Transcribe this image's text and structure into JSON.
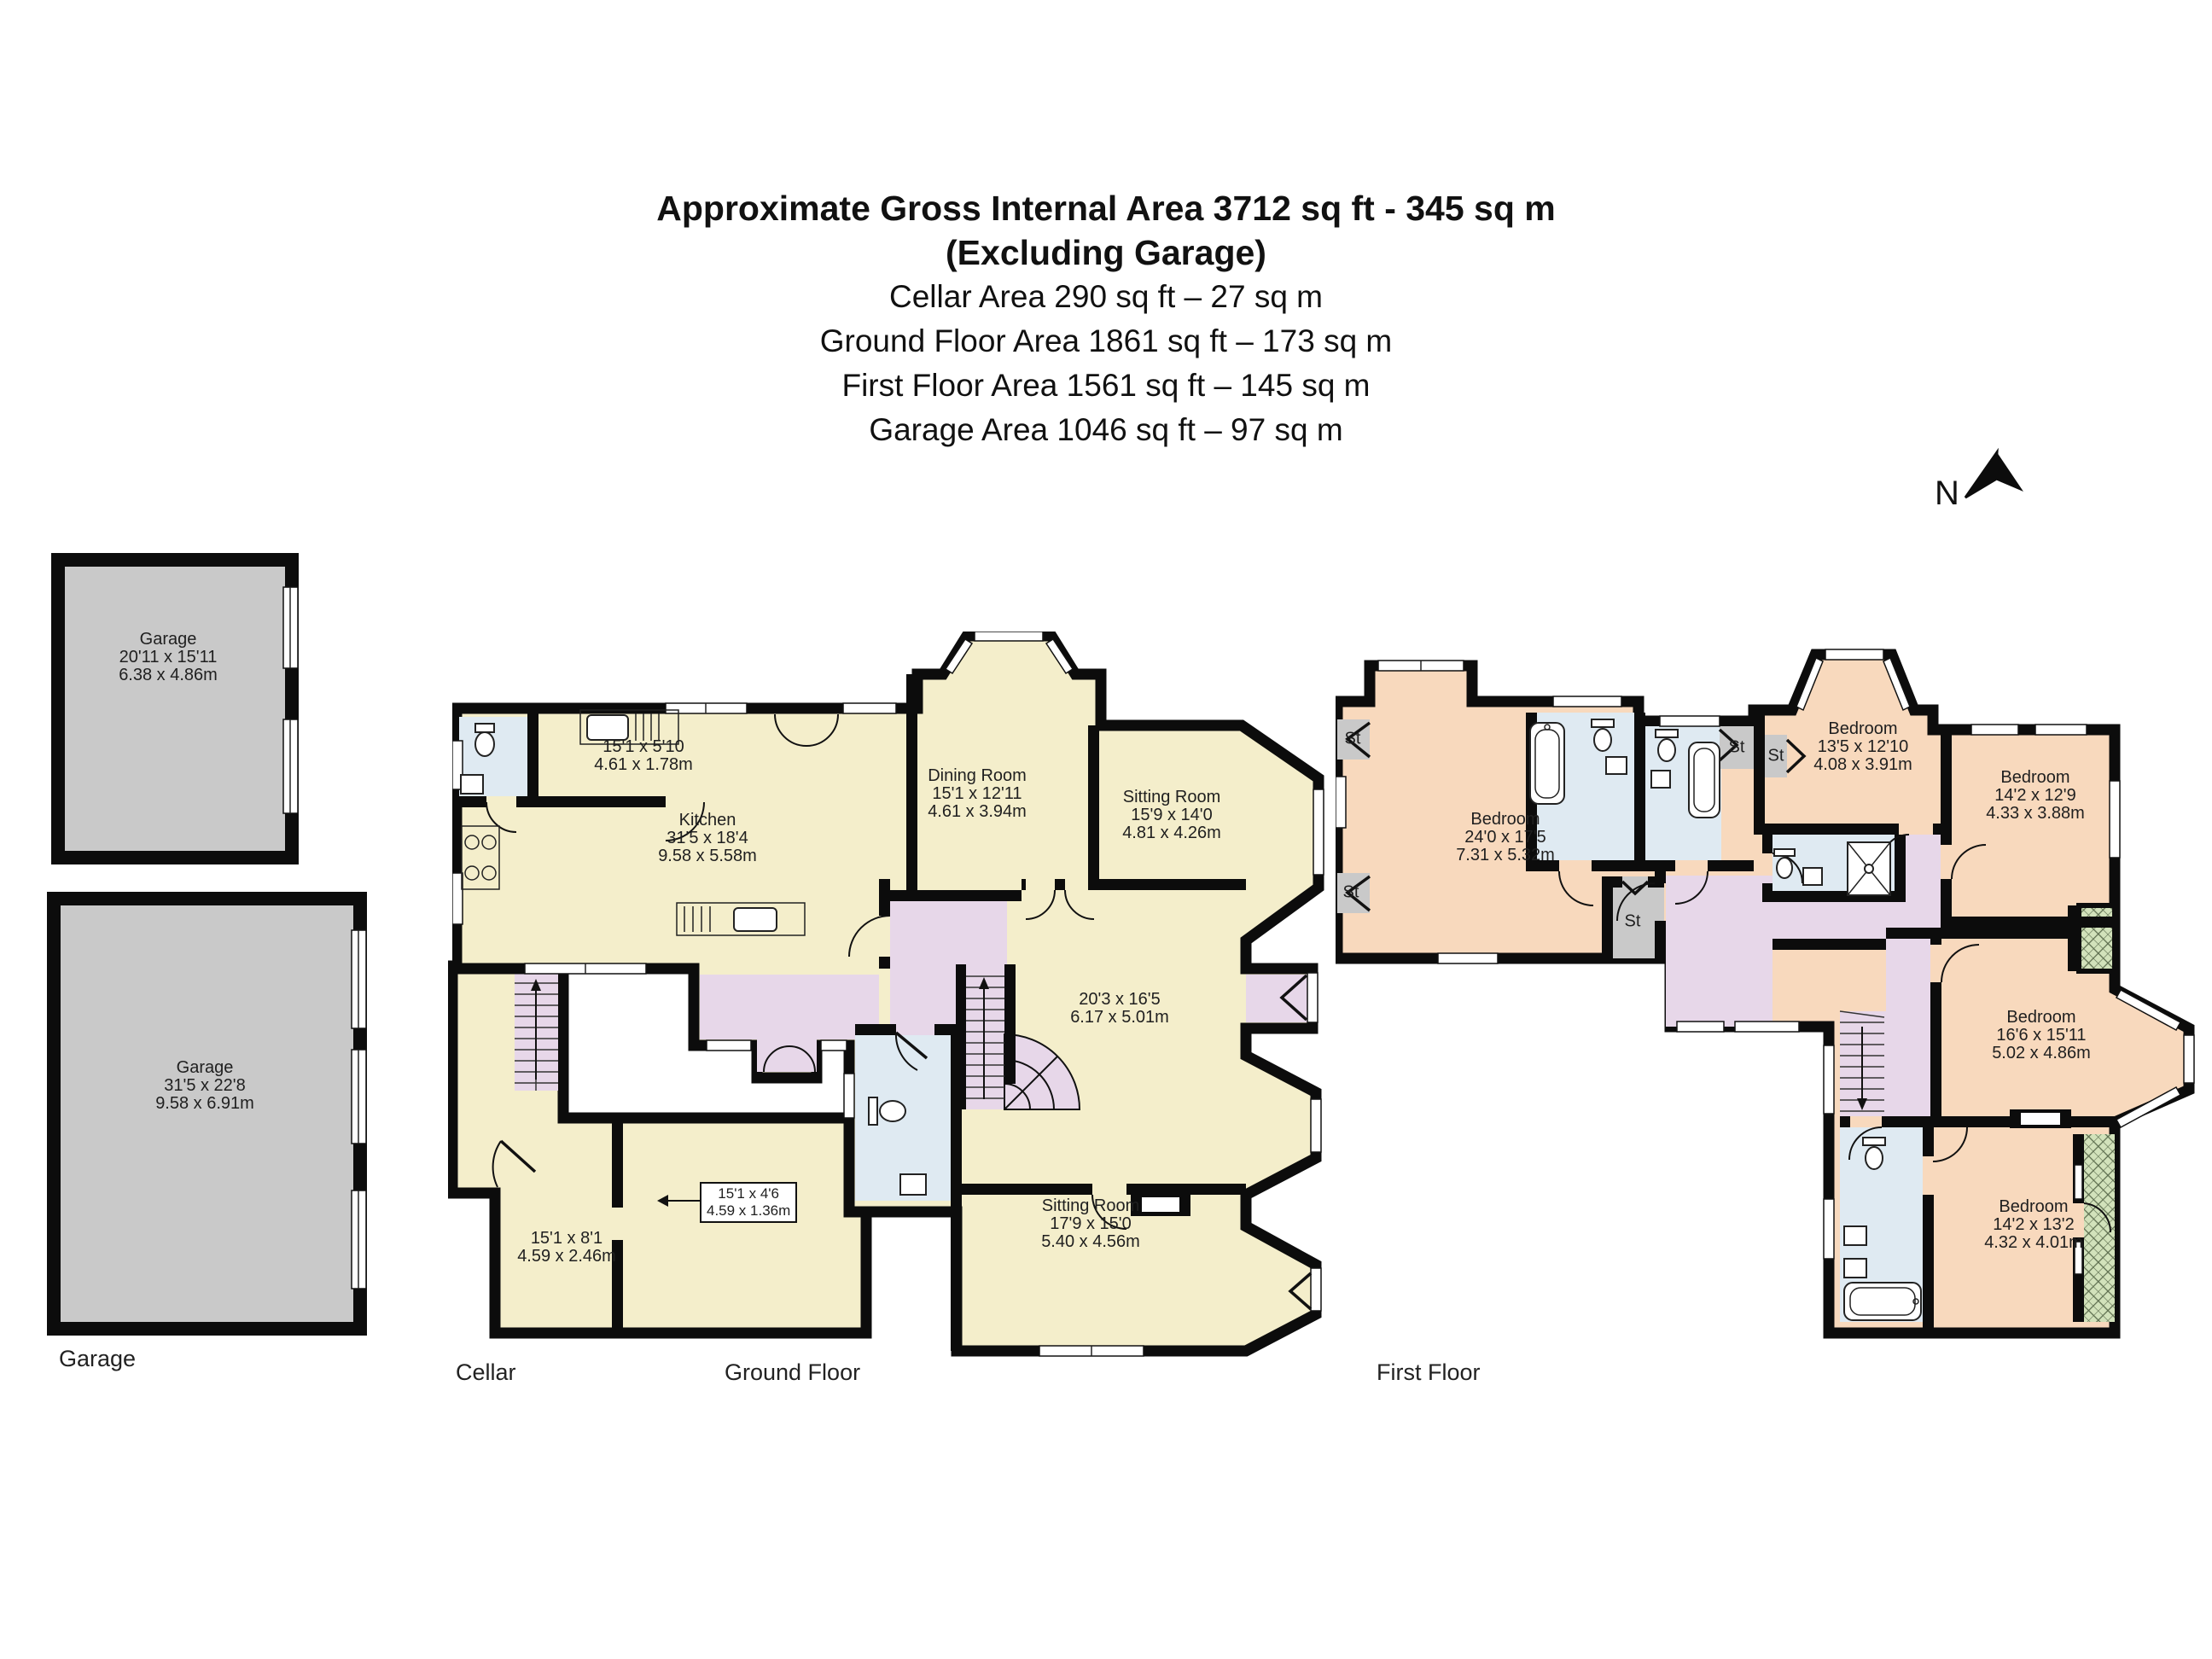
{
  "header": {
    "title": "Approximate Gross Internal Area 3712 sq ft - 345 sq m",
    "subtitle": "(Excluding Garage)",
    "areas": [
      "Cellar Area 290 sq ft – 27 sq m",
      "Ground Floor Area 1861 sq ft – 173 sq m",
      "First Floor Area 1561 sq ft – 145 sq m",
      "Garage Area 1046 sq ft – 97 sq m"
    ]
  },
  "compass": {
    "north": "N"
  },
  "captions": {
    "garage": "Garage",
    "cellar": "Cellar",
    "ground": "Ground Floor",
    "first": "First Floor"
  },
  "plans": {
    "garage_top": {
      "name": "Garage",
      "imperial": "20'11 x 15'11",
      "metric": "6.38 x 4.86m"
    },
    "garage_main": {
      "name": "Garage",
      "imperial": "31'5 x 22'8",
      "metric": "9.58 x 6.91m"
    },
    "cellar": {
      "room": {
        "imperial": "15'1 x 8'1",
        "metric": "4.59 x 2.46m"
      },
      "callout": {
        "imperial": "15'1 x 4'6",
        "metric": "4.59 x 1.36m"
      }
    },
    "ground": {
      "utility": {
        "imperial": "15'1 x 5'10",
        "metric": "4.61 x 1.78m"
      },
      "kitchen": {
        "name": "Kitchen",
        "imperial": "31'5 x 18'4",
        "metric": "9.58 x 5.58m"
      },
      "dining": {
        "name": "Dining Room",
        "imperial": "15'1 x 12'11",
        "metric": "4.61 x 3.94m"
      },
      "sitting_top": {
        "name": "Sitting Room",
        "imperial": "15'9 x 14'0",
        "metric": "4.81 x 4.26m"
      },
      "hall": {
        "imperial": "20'3 x 16'5",
        "metric": "6.17 x 5.01m"
      },
      "sitting_bottom": {
        "name": "Sitting Room",
        "imperial": "17'9 x 15'0",
        "metric": "5.40 x 4.56m"
      }
    },
    "first": {
      "st_label": "St",
      "master": {
        "name": "Bedroom",
        "imperial": "24'0 x 17'5",
        "metric": "7.31 x 5.32m"
      },
      "bed2": {
        "name": "Bedroom",
        "imperial": "13'5 x 12'10",
        "metric": "4.08 x 3.91m"
      },
      "bed3": {
        "name": "Bedroom",
        "imperial": "14'2 x 12'9",
        "metric": "4.33 x 3.88m"
      },
      "bed4": {
        "name": "Bedroom",
        "imperial": "16'6 x 15'11",
        "metric": "5.02 x 4.86m"
      },
      "bed5": {
        "name": "Bedroom",
        "imperial": "14'2 x 13'2",
        "metric": "4.32 x 4.01m"
      }
    }
  },
  "colors": {
    "wall": "#0c0c0c",
    "room_cream": "#f4eecb",
    "hall_lilac": "#e7d7e9",
    "bath_blue": "#dfeaf2",
    "bedroom_peach": "#f8d9bd",
    "garage_gray": "#c9c9c9",
    "balcony_green": "#d2e2bb",
    "text": "#1f1f1f"
  }
}
